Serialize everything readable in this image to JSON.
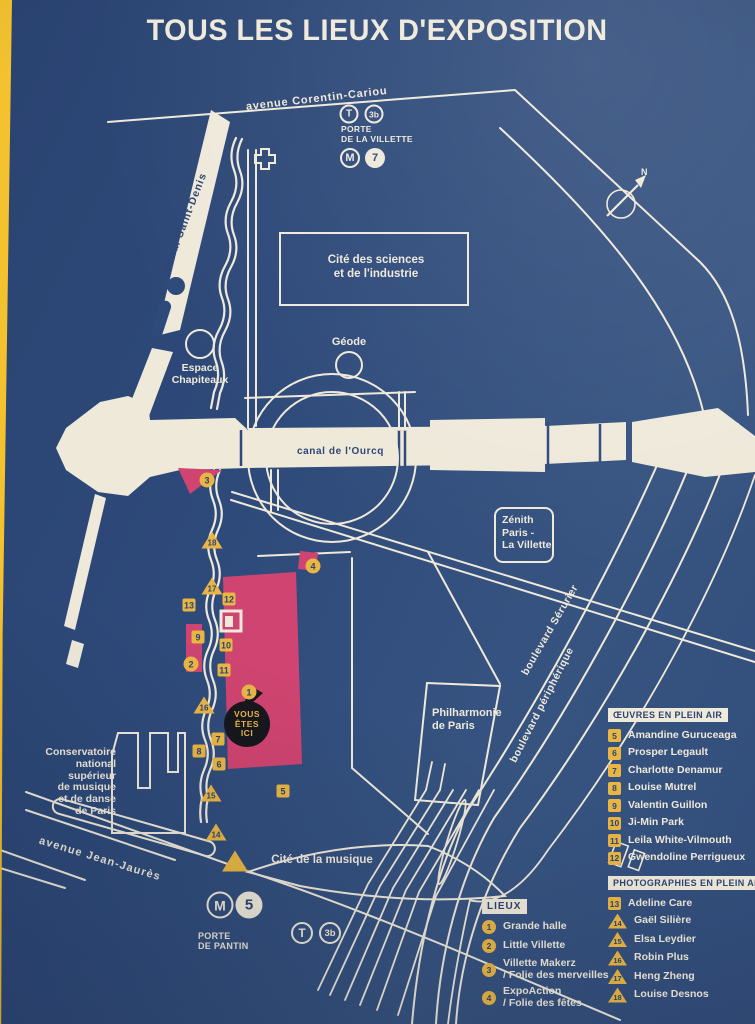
{
  "title": "TOUS LES LIEUX D'EXPOSITION",
  "compass": {
    "label": "N"
  },
  "you_are_here": "VOUS\nÊTES\nICI",
  "streets": {
    "corentin_cariou": "avenue Corentin-Cariou",
    "canal_saint_denis": "canal Saint-Denis",
    "canal_ourcq": "canal de l'Ourcq",
    "serurier": "boulevard Sérurier",
    "peripherique": "boulevard périphérique",
    "jean_jaures": "avenue Jean-Jaurès"
  },
  "places": {
    "cite_sciences": "Cité des sciences\net de l'industrie",
    "geode": "Géode",
    "espace_chapiteaux": "Espace\nChapiteaux",
    "zenith": "Zénith\nParis -\nLa Villette",
    "philharmonie": "Philharmonie\nde Paris",
    "cite_musique": "Cité de la musique",
    "conservatoire": "Conservatoire\nnational\nsupérieur\nde musique\net de danse\nde Paris"
  },
  "transit": {
    "villette": {
      "tram": "T",
      "tram_line": "3b",
      "station": "PORTE\nDE LA VILLETTE",
      "metro": "M",
      "metro_line": "7"
    },
    "pantin": {
      "metro": "M",
      "metro_line": "5",
      "station": "PORTE\nDE PANTIN",
      "tram": "T",
      "tram_line": "3b"
    }
  },
  "legend_lieux": {
    "header": "LIEUX",
    "items": [
      {
        "n": "1",
        "label": "Grande halle"
      },
      {
        "n": "2",
        "label": "Little Villette"
      },
      {
        "n": "3",
        "label": "Villette Makerz\n/ Folie des merveilles"
      },
      {
        "n": "4",
        "label": "ExpoAction\n/ Folie des fêtes"
      }
    ]
  },
  "legend_oeuvres": {
    "header": "ŒUVRES EN PLEIN AIR",
    "items": [
      {
        "n": "5",
        "label": "Amandine Guruceaga"
      },
      {
        "n": "6",
        "label": "Prosper Legault"
      },
      {
        "n": "7",
        "label": "Charlotte Denamur"
      },
      {
        "n": "8",
        "label": "Louise Mutrel"
      },
      {
        "n": "9",
        "label": "Valentin Guillon"
      },
      {
        "n": "10",
        "label": "Ji-Min Park"
      },
      {
        "n": "11",
        "label": "Leila White-Vilmouth"
      },
      {
        "n": "12",
        "label": "Gwendoline Perrigueux"
      }
    ]
  },
  "legend_photos": {
    "header": "PHOTOGRAPHIES EN PLEIN AIR",
    "items": [
      {
        "n": "13",
        "label": "Adeline Care",
        "shape": "square"
      },
      {
        "n": "14",
        "label": "Gaël Silière",
        "shape": "triangle"
      },
      {
        "n": "15",
        "label": "Elsa Leydier",
        "shape": "triangle"
      },
      {
        "n": "16",
        "label": "Robin Plus",
        "shape": "triangle"
      },
      {
        "n": "17",
        "label": "Heng Zheng",
        "shape": "triangle"
      },
      {
        "n": "18",
        "label": "Louise Desnos",
        "shape": "triangle"
      }
    ]
  },
  "map_markers": [
    {
      "n": "1",
      "shape": "circle"
    },
    {
      "n": "2",
      "shape": "circle"
    },
    {
      "n": "3",
      "shape": "circle"
    },
    {
      "n": "4",
      "shape": "circle"
    },
    {
      "n": "5",
      "shape": "square"
    },
    {
      "n": "6",
      "shape": "square"
    },
    {
      "n": "7",
      "shape": "square"
    },
    {
      "n": "8",
      "shape": "square"
    },
    {
      "n": "9",
      "shape": "square"
    },
    {
      "n": "10",
      "shape": "square"
    },
    {
      "n": "11",
      "shape": "square"
    },
    {
      "n": "12",
      "shape": "square"
    },
    {
      "n": "13",
      "shape": "square"
    },
    {
      "n": "14",
      "shape": "triangle"
    },
    {
      "n": "15",
      "shape": "triangle"
    },
    {
      "n": "16",
      "shape": "triangle"
    },
    {
      "n": "17",
      "shape": "triangle"
    },
    {
      "n": "18",
      "shape": "triangle"
    }
  ],
  "colors": {
    "background": "#2e4a7a",
    "cream": "#efe9da",
    "yellow": "#e9b644",
    "pink": "#cf4470",
    "pin_black": "#17171d",
    "edge_stripe": "#f4c22f"
  }
}
